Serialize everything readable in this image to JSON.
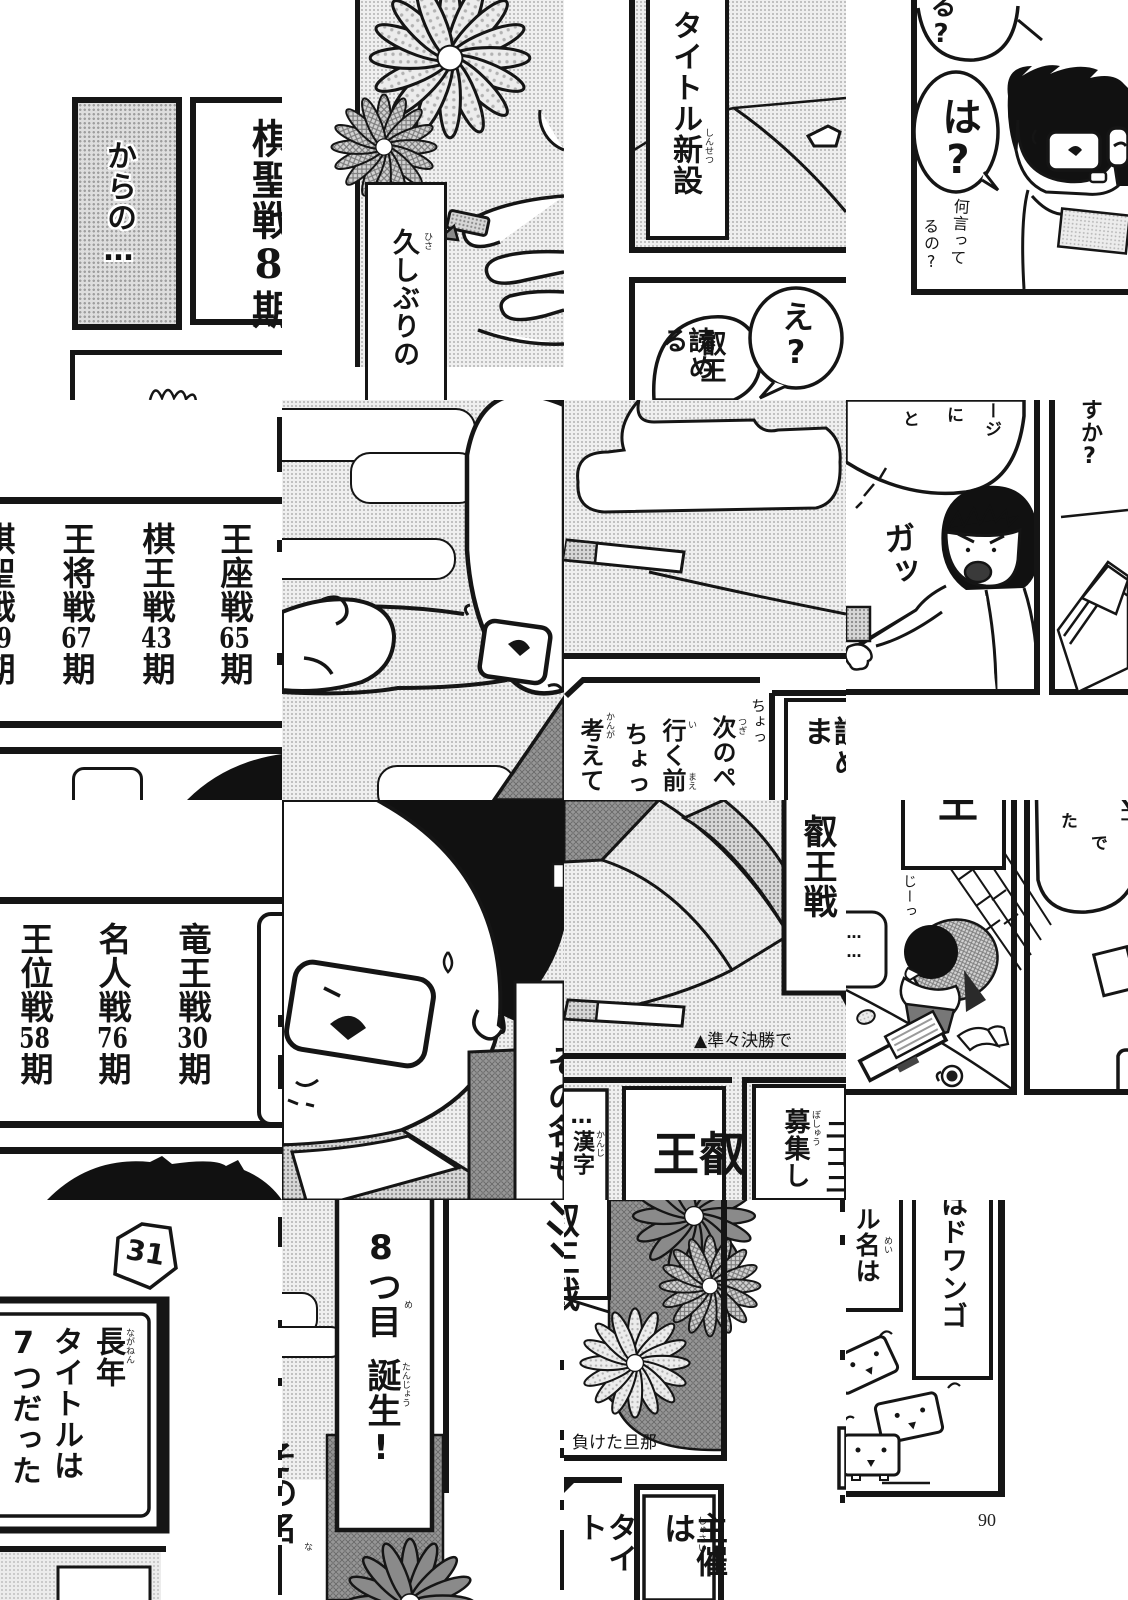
{
  "page_number": "90",
  "t00": {
    "caption": "からの…",
    "side_title": "棋聖戦8期"
  },
  "t10": {
    "banner": "久しぶりの",
    "banner_furi": "ひさ"
  },
  "t20": {
    "banner": "タイトル新設",
    "banner_furi": "しんせつ",
    "bubble": "え?",
    "speech_main": "叡王",
    "speech_sub": "読める",
    "speech_sub_furi": "よ"
  },
  "t30": {
    "bubble_top": "る?",
    "bubble_main": "は?",
    "mutter_a": "何言って",
    "mutter_b": "るの?"
  },
  "t01": {
    "titles": [
      {
        "name": "王座戦",
        "num": "65",
        "suffix": "期"
      },
      {
        "name": "棋王戦",
        "num": "43",
        "suffix": "期"
      },
      {
        "name": "王将戦",
        "num": "67",
        "suffix": "期"
      },
      {
        "name": "棋聖戦",
        "num": "89",
        "suffix": "期"
      }
    ]
  },
  "t21": {
    "cols": [
      {
        "text": "次のペ",
        "furi": "つぎ"
      },
      {
        "text": "行く前",
        "furi": "い"
      },
      {
        "text": "ちょっ",
        "furi": ""
      },
      {
        "text": "考えて",
        "furi": "かんが"
      }
    ],
    "furi_mae": "まえ",
    "hand": "ちょっ",
    "right_text": "読めま",
    "right_furi": "よ"
  },
  "t31": {
    "frag_a": "ージ",
    "frag_b": "に",
    "frag_c": "と",
    "sfx": "ガッ",
    "right_text": "すか?"
  },
  "t02": {
    "titles": [
      {
        "name": "竜王戦",
        "num": "30",
        "suffix": "期"
      },
      {
        "name": "名人戦",
        "num": "76",
        "suffix": "期"
      },
      {
        "name": "王位戦",
        "num": "58",
        "suffix": "期"
      }
    ]
  },
  "t12": {
    "side_text": "その名も"
  },
  "t22": {
    "banner": "叡王戦",
    "caption": "▲準々決勝で",
    "box_small": "…漢字",
    "box_small_furi": "かんじ",
    "box_big": "叡王",
    "right_a": "募集し",
    "right_a_furi": "ぼしゅう",
    "right_b": "ニコニ"
  },
  "t32": {
    "banner_frag": "王",
    "stare": "じーっ",
    "dots": "……",
    "frag_ta": "た",
    "frag_de": "で",
    "frag_ko": "コ"
  },
  "t03": {
    "piece_num": "31",
    "line1": "長年",
    "line1_furi": "ながねん",
    "line2": "タイトルは",
    "line3": "7つだった"
  },
  "t13": {
    "banner_a": "8つ目",
    "banner_a_furi": "め",
    "banner_b": "誕生!",
    "banner_b_furi": "たんじょう",
    "side_text": "その名",
    "side_furi": "な"
  },
  "t23": {
    "side_banner": "叡王戦",
    "caption": "負けた旦那",
    "col_left": "タイト",
    "box_text": "主催は",
    "box_furi": "しゅさい"
  },
  "t33": {
    "banner_a": "ル名は",
    "banner_a_furi": "めい",
    "banner_b": "はドワンゴ"
  }
}
